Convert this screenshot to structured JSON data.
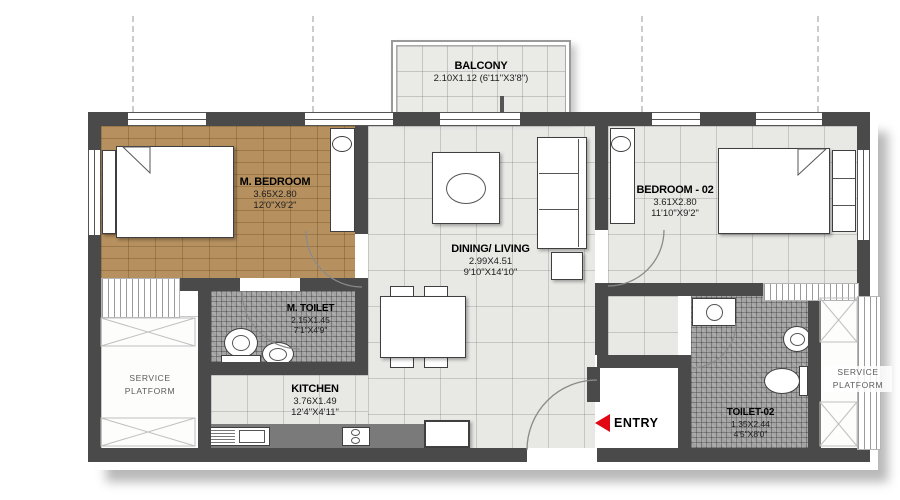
{
  "rooms": {
    "balcony": {
      "name": "BALCONY",
      "dims": "2.10X1.12 (6'11\"X3'8\")"
    },
    "m_bedroom": {
      "name": "M. BEDROOM",
      "dims_m": "3.65X2.80",
      "dims_ft": "12'0\"X9'2\""
    },
    "bedroom_02": {
      "name": "BEDROOM - 02",
      "dims_m": "3.61X2.80",
      "dims_ft": "11'10\"X9'2\""
    },
    "dining_living": {
      "name": "DINING/ LIVING",
      "dims_m": "2.99X4.51",
      "dims_ft": "9'10\"X14'10\""
    },
    "m_toilet": {
      "name": "M. TOILET",
      "dims_m": "2.15X1.45",
      "dims_ft": "7'1\"X4'9\""
    },
    "kitchen": {
      "name": "KITCHEN",
      "dims_m": "3.76X1.49",
      "dims_ft": "12'4\"X4'11\""
    },
    "toilet_02": {
      "name": "TOILET-02",
      "dims_m": "1.35X2.44",
      "dims_ft": "4'5\"X8'0\""
    },
    "service_platform_left": {
      "name": "SERVICE PLATFORM"
    },
    "service_platform_right": {
      "name": "SERVICE PLATFORM"
    }
  },
  "entry": {
    "label": "ENTRY"
  },
  "colors": {
    "wall": "#4a4a4a",
    "wood_floor": "#b6905f",
    "tile_floor": "#e8e8e5",
    "mosaic_floor": "#a3a3a3",
    "counter": "#7a7a7a",
    "entry_arrow": "#e30613"
  }
}
